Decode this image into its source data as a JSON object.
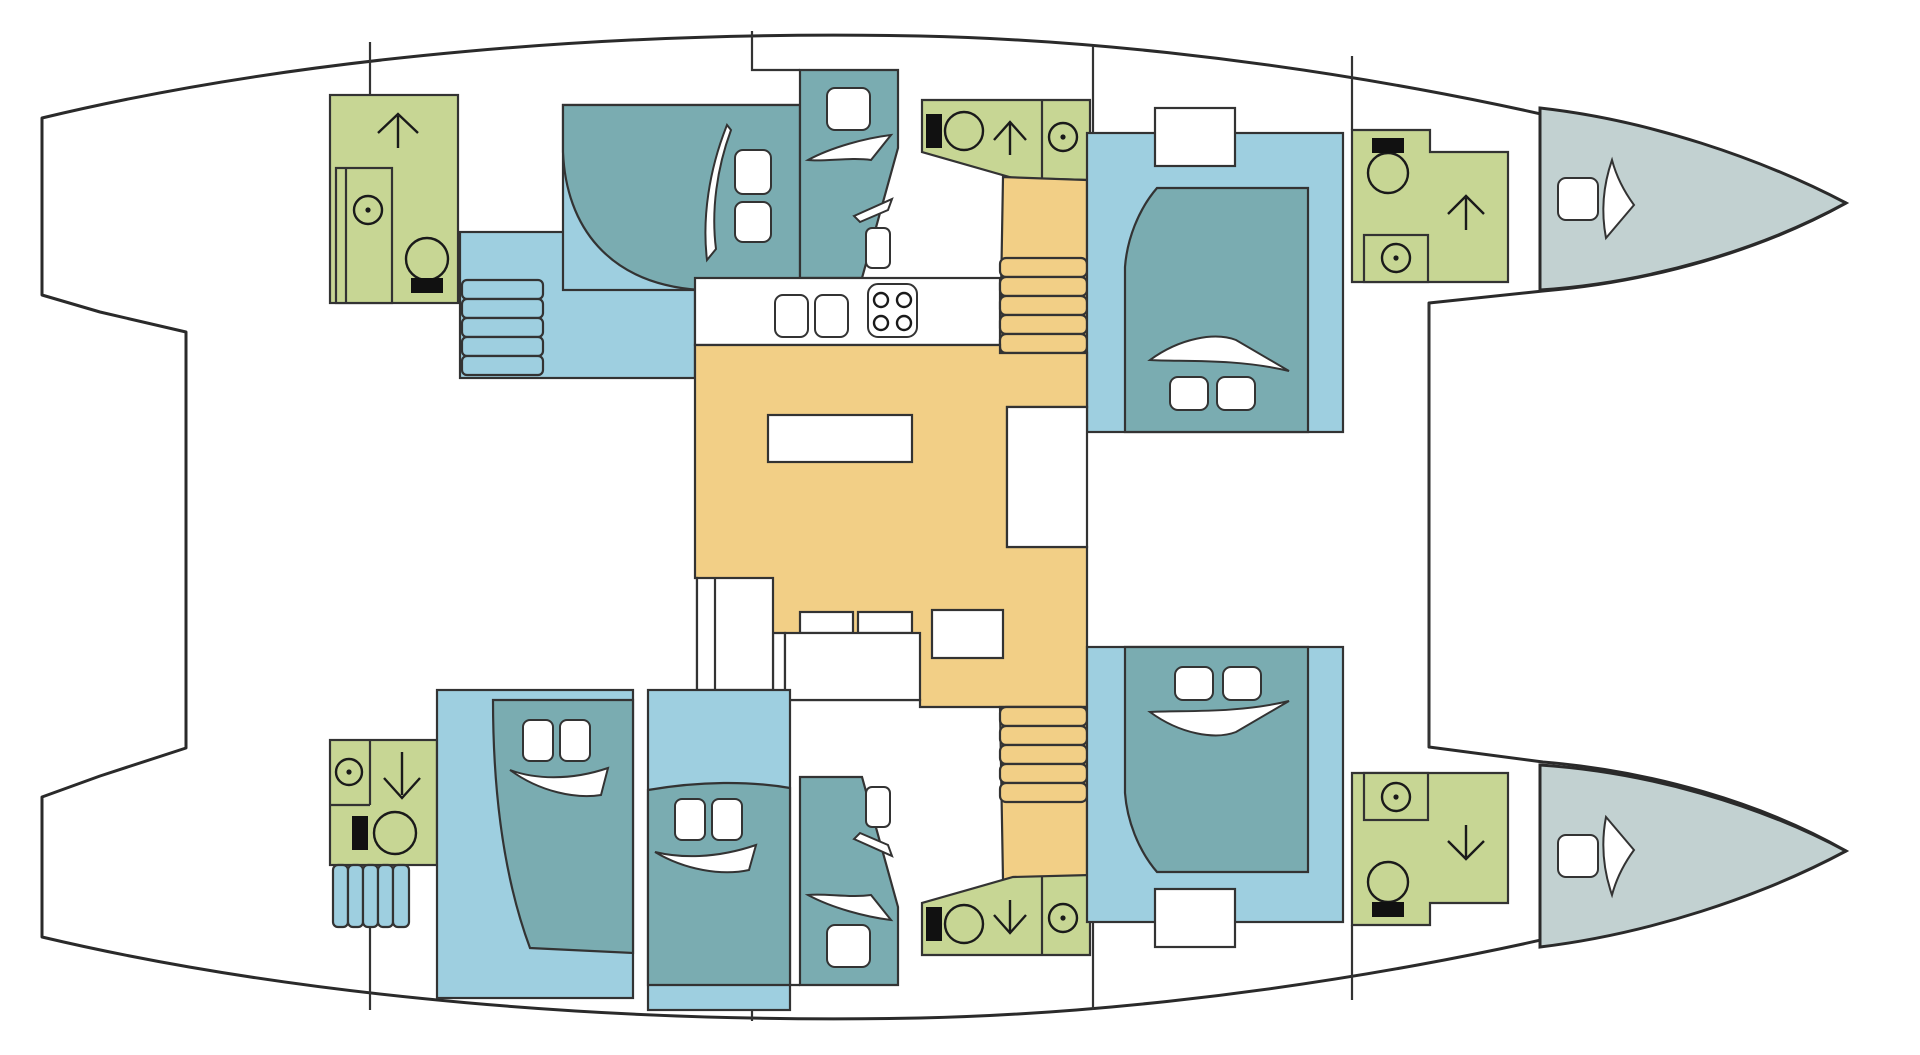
{
  "document": {
    "title": "Catamaran interior deck plan (top view, bows to the right)",
    "type": "boat-floor-plan"
  },
  "palette": {
    "hull_outline": "#2a2a2a",
    "deck_white": "#ffffff",
    "cabin_light_blue": "#9ecfe0",
    "bed_teal": "#7aacb1",
    "bathroom_green": "#c7d694",
    "salon_orange": "#f2cf86",
    "bow_gray": "#c2d1d1",
    "fixture_black": "#111111"
  },
  "rooms": [
    {
      "id": "bathroom-port-aft",
      "label": "Port aft bathroom: shower stall, toilet, companionway up",
      "color_key": "bathroom_green"
    },
    {
      "id": "cabin-port-aft",
      "label": "Port aft double cabin with island bed, two pillows and entry steps",
      "color_key": "cabin_light_blue"
    },
    {
      "id": "berth-port-mid",
      "label": "Port midship single berth",
      "color_key": "bed_teal"
    },
    {
      "id": "galley",
      "label": "Galley counter with twin sinks and 4-burner stove",
      "color_key": "deck_white"
    },
    {
      "id": "bathroom-port-mid",
      "label": "Port mid bathroom: toilet, companionway up, shower",
      "color_key": "bathroom_green"
    },
    {
      "id": "stairs-port",
      "label": "Port hull companionway stairs",
      "color_key": "salon_orange"
    },
    {
      "id": "cabin-port-forward",
      "label": "Port forward double cabin with deck hatch",
      "color_key": "cabin_light_blue"
    },
    {
      "id": "bathroom-port-forward",
      "label": "Port forward bathroom: toilet, companionway up, shower",
      "color_key": "bathroom_green"
    },
    {
      "id": "bow-port",
      "label": "Port bow compartment with hatch",
      "color_key": "bow_gray"
    },
    {
      "id": "salon",
      "label": "Salon: dining table, L-shaped sofa, nav seat",
      "color_key": "salon_orange"
    },
    {
      "id": "stairs-starboard",
      "label": "Starboard hull companionway stairs",
      "color_key": "salon_orange"
    },
    {
      "id": "bathroom-starboard-aft",
      "label": "Starboard aft bathroom: shower, companionway down, toilet, deck steps",
      "color_key": "bathroom_green"
    },
    {
      "id": "cabin-starboard-aft",
      "label": "Starboard aft double cabin",
      "color_key": "cabin_light_blue"
    },
    {
      "id": "cabin-starboard-mid",
      "label": "Starboard mid double cabin",
      "color_key": "cabin_light_blue"
    },
    {
      "id": "berth-starboard-mid",
      "label": "Starboard midship single berth",
      "color_key": "bed_teal"
    },
    {
      "id": "bathroom-starboard-mid",
      "label": "Starboard mid bathroom: toilet, companionway down, shower",
      "color_key": "bathroom_green"
    },
    {
      "id": "cabin-starboard-forward",
      "label": "Starboard forward double cabin with deck hatch",
      "color_key": "cabin_light_blue"
    },
    {
      "id": "bathroom-starboard-forward",
      "label": "Starboard forward bathroom: shower, companionway down, toilet",
      "color_key": "bathroom_green"
    },
    {
      "id": "bow-starboard",
      "label": "Starboard bow compartment with hatch",
      "color_key": "bow_gray"
    }
  ],
  "icons": [
    "shower-icon",
    "toilet-icon",
    "companionway-arrow-up-icon",
    "companionway-arrow-down-icon",
    "steps-icon",
    "pillow-icon",
    "bedding-fold-icon",
    "sink-icon",
    "stove-icon",
    "hatch-icon",
    "dining-table-icon",
    "sofa-icon"
  ],
  "counts": {
    "double_cabins": 5,
    "single_berths": 2,
    "bathrooms": 6,
    "interior_stair_flights": 2,
    "deck_step_flights": 2,
    "bow_compartments": 2,
    "stove_burners": 4,
    "sinks": 2
  }
}
